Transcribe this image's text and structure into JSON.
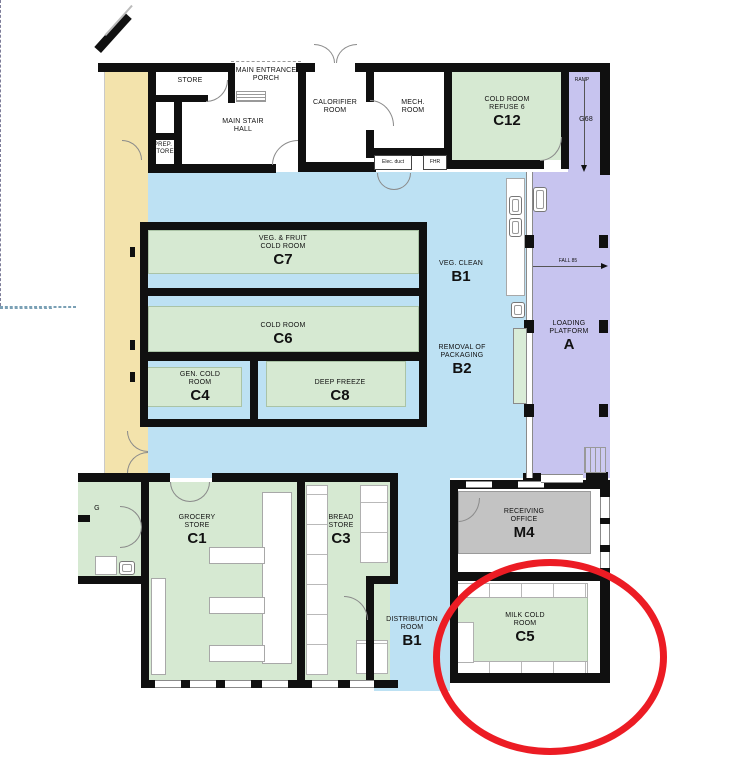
{
  "document": {
    "type": "floor-plan",
    "highlighted_room": "C5"
  },
  "colors": {
    "wall": "#101010",
    "zone_cream": "#F3E3AC",
    "zone_blue": "#BDE1F3",
    "zone_green": "#D6E9D2",
    "zone_purple": "#C7C4EF",
    "zone_gray": "#C3C3C3",
    "highlight_red": "#EC1C24"
  },
  "rooms": {
    "store": {
      "lines": [
        "STORE"
      ]
    },
    "porch": {
      "lines": [
        "MAIN ENTRANCE",
        "PORCH"
      ]
    },
    "stair_hall": {
      "lines": [
        "MAIN STAIR",
        "HALL"
      ]
    },
    "prep_store": {
      "lines": [
        "PREP.",
        "STORE"
      ]
    },
    "calorifier": {
      "lines": [
        "CALORIFIER",
        "ROOM"
      ]
    },
    "mech": {
      "lines": [
        "MECH.",
        "ROOM"
      ]
    },
    "c12": {
      "lines": [
        "COLD ROOM",
        "REFUSE 6"
      ],
      "code": "C12"
    },
    "ramp": {
      "label": "RAMP",
      "code": "G68"
    },
    "c7": {
      "lines": [
        "VEG. & FRUIT",
        "COLD ROOM"
      ],
      "code": "C7"
    },
    "veg_clean": {
      "lines": [
        "VEG. CLEAN"
      ],
      "code": "B1"
    },
    "c6": {
      "lines": [
        "COLD ROOM"
      ],
      "code": "C6"
    },
    "removal": {
      "lines": [
        "REMOVAL OF",
        "PACKAGING"
      ],
      "code": "B2"
    },
    "c4": {
      "lines": [
        "GEN. COLD",
        "ROOM"
      ],
      "code": "C4"
    },
    "c8": {
      "lines": [
        "DEEP FREEZE"
      ],
      "code": "C8"
    },
    "loading": {
      "lines": [
        "LOADING",
        "PLATFORM"
      ],
      "code": "A"
    },
    "c1": {
      "lines": [
        "GROCERY",
        "STORE"
      ],
      "code": "C1"
    },
    "c3": {
      "lines": [
        "BREAD",
        "STORE"
      ],
      "code": "C3"
    },
    "distribution": {
      "lines": [
        "DISTRIBUTION",
        "ROOM"
      ],
      "code": "B1"
    },
    "m4": {
      "lines": [
        "RECEIVING",
        "OFFICE"
      ],
      "code": "M4"
    },
    "c5": {
      "lines": [
        "MILK COLD",
        "ROOM"
      ],
      "code": "C5"
    }
  },
  "annotations": {
    "fall_label": "FALL 85",
    "elec_duct": "Elec. duct",
    "fhr": "FHR",
    "edge_fragment": "G"
  }
}
